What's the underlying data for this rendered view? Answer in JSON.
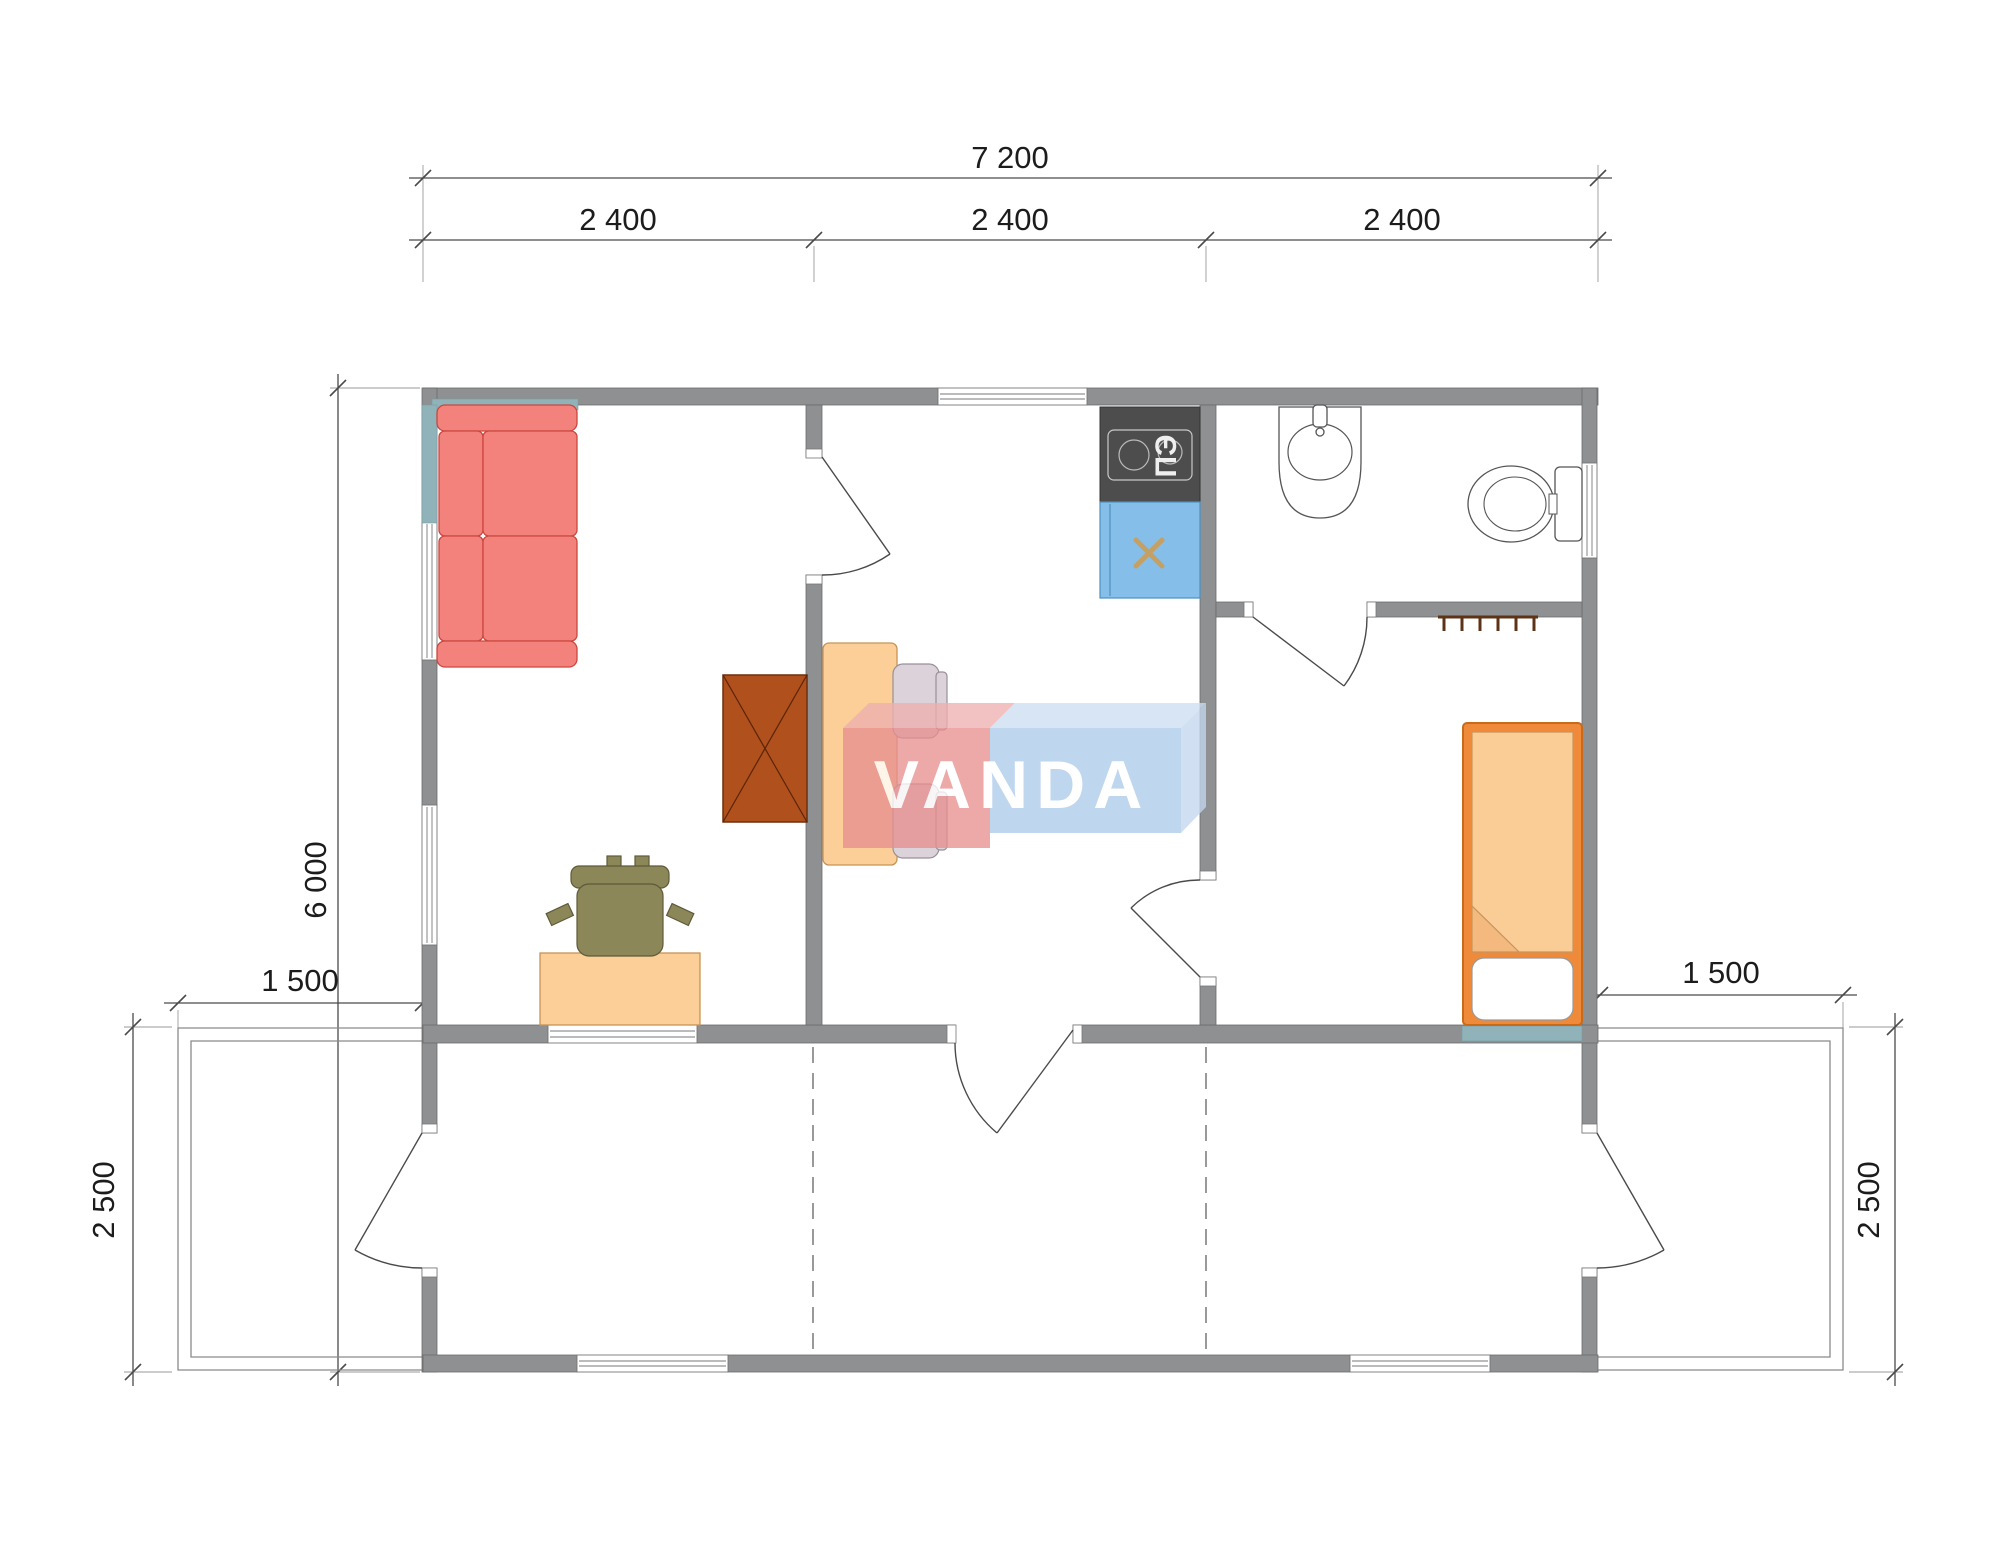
{
  "watermark": {
    "brand": "VANDA"
  },
  "dimensions": {
    "overall_width": "7 200",
    "module_1": "2 400",
    "module_2": "2 400",
    "module_3": "2 400",
    "overall_depth": "6 000",
    "terrace_left_width": "1 500",
    "terrace_left_depth": "2 500",
    "terrace_right_width": "1 500",
    "terrace_right_depth": "2 500"
  },
  "labels": {
    "electric_stove": "ПЭ"
  },
  "colors": {
    "wall": "#8E9092",
    "sofa": "#F4827C",
    "wardrobe": "#B0501C",
    "desk_and_table": "#FBCF97",
    "office_chair": "#8C8758",
    "dining_chair": "#DBD2DA",
    "stove": "#4D4D4D",
    "sink": "#85BEE9",
    "bed_frame": "#EF8A3B",
    "bed_blanket": "#FACD96",
    "headboard": "#8FB3B8",
    "watermark_red": "#E89090",
    "watermark_blue": "#AECBEB"
  }
}
